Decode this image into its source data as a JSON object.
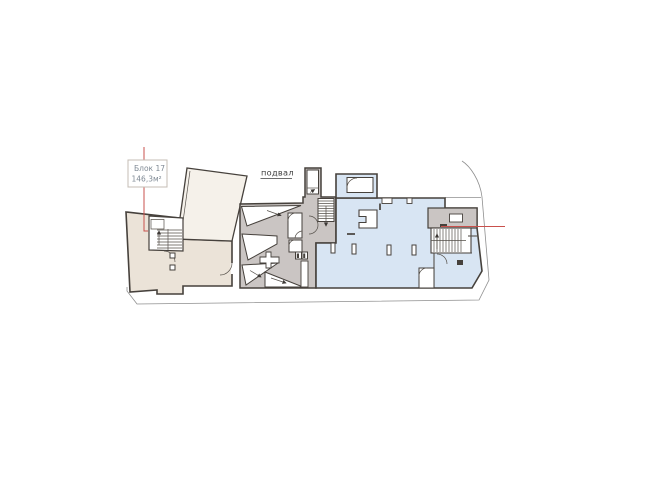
{
  "page": {
    "type": "basement-floor-plan-screenshot",
    "background": "#ffffff"
  },
  "labels": {
    "block_label": {
      "name": "Блок 17",
      "area": "146,3м²"
    },
    "floor_label": "подвал"
  },
  "plan": {
    "floor": "подвал",
    "highlighted_block": {
      "id": "Блок 17",
      "area": "146,3м²"
    },
    "sections": [
      {
        "name": "block-17",
        "fill": "#ebe3d8"
      },
      {
        "name": "ramp-and-stair-core",
        "fill": "#cac5c3"
      },
      {
        "name": "main-hall",
        "fill": "#d8e5f3"
      }
    ],
    "leader_lines": {
      "color": "#c9504c",
      "count": 2
    }
  },
  "colors": {
    "wall_outline": "#46413c",
    "site_outline": "#8f8f8f",
    "block17_fill": "#ebe3d8",
    "core_fill": "#cac5c3",
    "hall_fill": "#d8e5f3",
    "ramp_fill": "#f5f1ea",
    "leader_red": "#c9504c",
    "label_text": "#7f8a95",
    "floor_text": "#3d3d3d",
    "label_box_border": "#c4bcb4"
  }
}
